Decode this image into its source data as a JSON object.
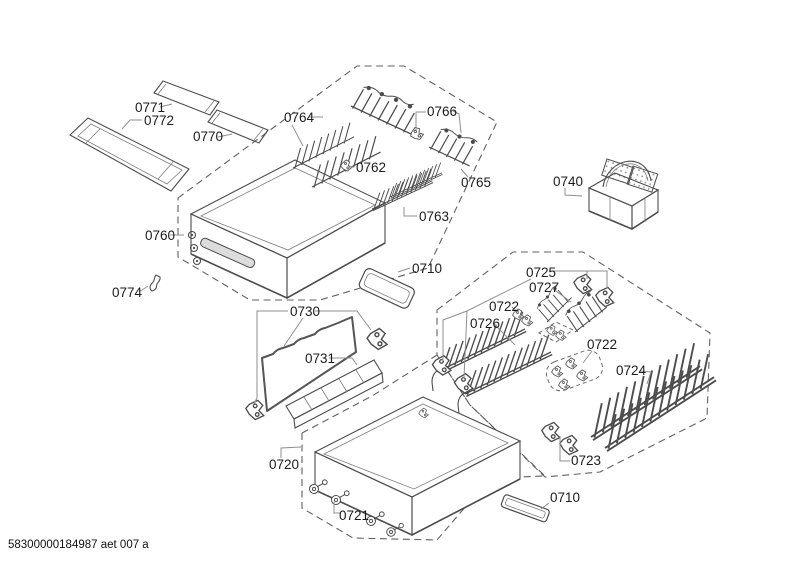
{
  "diagram": {
    "footer": "58300000184987 aet 007 a",
    "callouts": {
      "c0771": "0771",
      "c0772": "0772",
      "c0770": "0770",
      "c0760": "0760",
      "c0774": "0774",
      "c0764": "0764",
      "c0762": "0762",
      "c0766": "0766",
      "c0765": "0765",
      "c0763": "0763",
      "c0740": "0740",
      "c0710_top": "0710",
      "c0730": "0730",
      "c0731": "0731",
      "c0725": "0725",
      "c0727": "0727",
      "c0722_top": "0722",
      "c0726": "0726",
      "c0722_mid": "0722",
      "c0724": "0724",
      "c0720": "0720",
      "c0721": "0721",
      "c0723": "0723",
      "c0710_bottom": "0710"
    },
    "colors": {
      "line": "#4c4c4c",
      "dashed_region": "#616161",
      "leader_line": "#8f8f8f",
      "label_text": "#1c1c1c",
      "background": "#ffffff"
    }
  }
}
